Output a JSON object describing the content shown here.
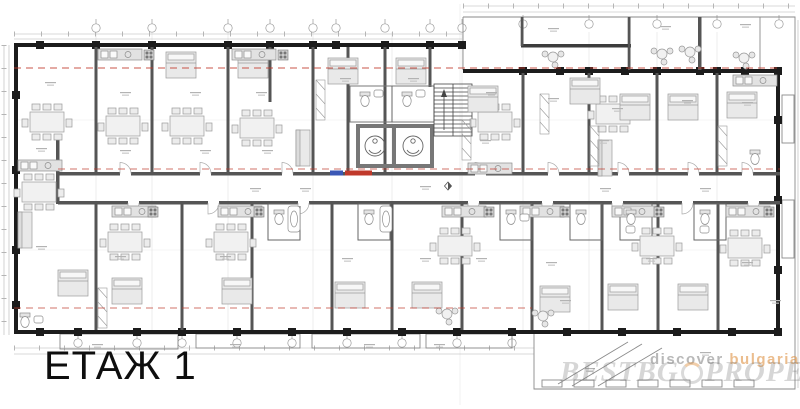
{
  "plan": {
    "title": "ЕТАЖ 1",
    "drawing_type": "apartment-building-floor-plan",
    "colors": {
      "background": "#ffffff",
      "wall_black": "#1c1c1c",
      "wall_gray": "#555555",
      "core_gray": "#777777",
      "furniture_fill": "#ececec",
      "furniture_stroke": "#9a9a9a",
      "hairline": "#c9c9c9",
      "section_line_red": "#c0392b",
      "marker_blue": "#3a57b5",
      "watermark_gray": "#7d7d7d",
      "watermark_orange": "#de9142"
    }
  },
  "watermark": {
    "word1": "discover",
    "word2": "bulgaria",
    "big_left": "BESTBG",
    "big_right": "PROPERTIES"
  }
}
